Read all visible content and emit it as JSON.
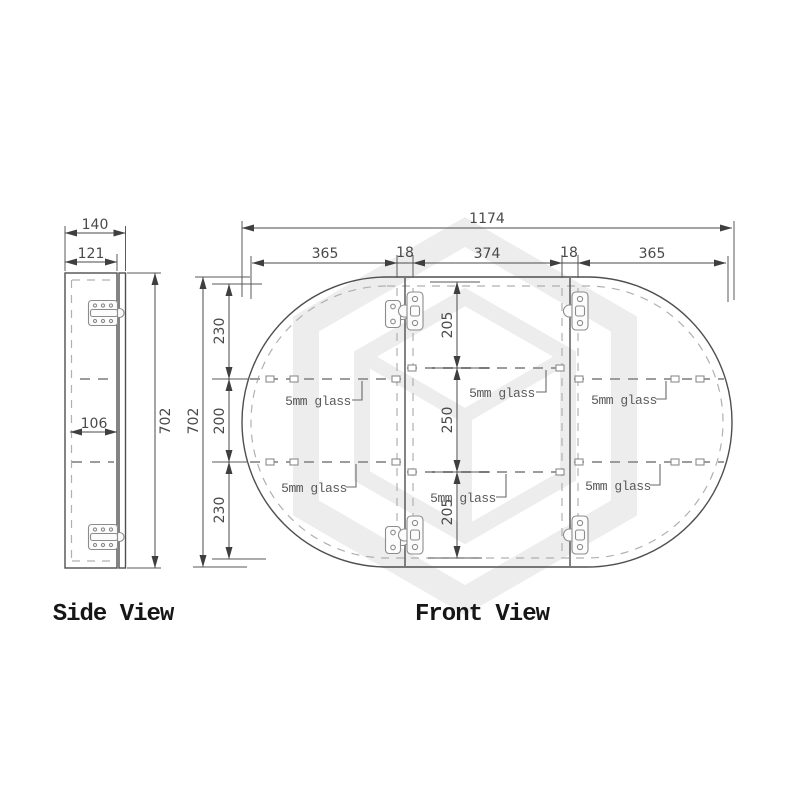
{
  "drawing": {
    "watermark_icon": "hexagon-logo",
    "colors": {
      "line": "#4f4f4f",
      "dashed": "#a3a3a3",
      "text": "#4a4a4a",
      "watermark": "#ededed"
    }
  },
  "side_view": {
    "label": "Side View",
    "dims": {
      "total_depth": "140",
      "body_depth": "121",
      "inner_depth": "106",
      "height": "702"
    }
  },
  "front_view": {
    "label": "Front View",
    "dims": {
      "total_width": "1174",
      "left_door": "365",
      "left_gap": "18",
      "center_door": "374",
      "right_gap": "18",
      "right_door": "365",
      "height": "702",
      "side_top": "230",
      "side_middle": "200",
      "side_bottom": "230",
      "center_top": "205",
      "center_middle": "250",
      "center_bottom": "205"
    },
    "glass_labels": [
      "5mm glass",
      "5mm glass",
      "5mm glass",
      "5mm glass",
      "5mm glass",
      "5mm glass"
    ]
  }
}
